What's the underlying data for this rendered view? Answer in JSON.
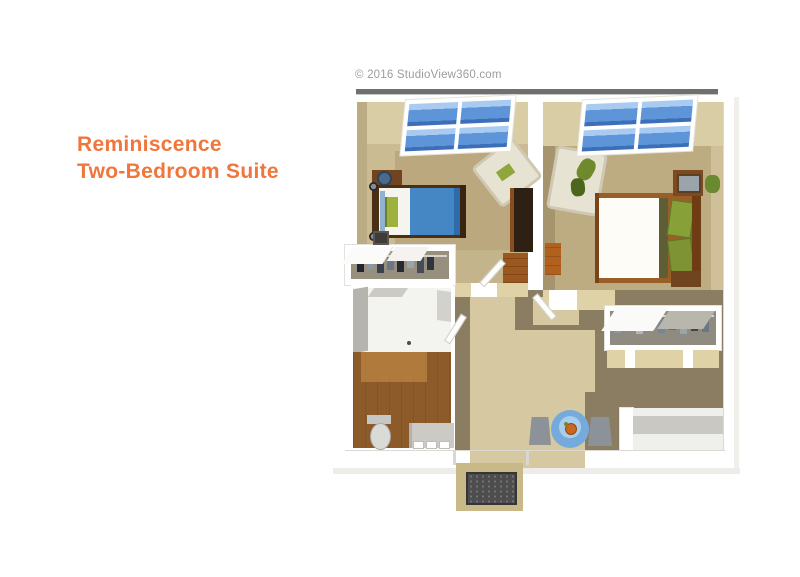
{
  "title": {
    "line1": "Reminiscence",
    "line2": "Two-Bedroom Suite",
    "color": "#F0763B"
  },
  "watermark": {
    "text": "© 2016 StudioView360.com",
    "color": "#9C9C9C"
  },
  "floorplan": {
    "type": "3d-birdseye-floor-plan",
    "unit_name": "Reminiscence Two-Bedroom Suite",
    "rooms": [
      {
        "name": "bedroom-1",
        "furniture": [
          "twin-bed-blue-blanket",
          "green-pillow",
          "nightstand-with-lamp",
          "bedside-stool",
          "cream-armchair",
          "dark-wardrobe",
          "dresser",
          "window-2x2-panes"
        ]
      },
      {
        "name": "bedroom-2",
        "furniture": [
          "bed-white-duvet",
          "green-pillows",
          "wood-bed-frame",
          "cream-armchair-with-plant",
          "media-dresser-tv",
          "small-plant",
          "orange-dresser",
          "nightstand",
          "window-2x2-panes"
        ]
      },
      {
        "name": "closet-1",
        "furniture": [
          "clothes-rod",
          "hanging-clothes",
          "sliding-door-panels"
        ]
      },
      {
        "name": "closet-2",
        "furniture": [
          "clothes-rod",
          "hanging-clothes",
          "sliding-door-panels"
        ]
      },
      {
        "name": "bathroom",
        "furniture": [
          "roll-in-shower",
          "shower-drain",
          "wood-floor",
          "toilet",
          "vanity-with-sink"
        ]
      },
      {
        "name": "living-dining",
        "furniture": [
          "round-blue-table",
          "orange-centerpiece",
          "dining-chair-left",
          "dining-chair-right"
        ]
      },
      {
        "name": "entry",
        "furniture": [
          "threshold",
          "doormat"
        ]
      }
    ],
    "colors": {
      "wall_white": "#FFFFFF",
      "wall_face_beige": "#D9CDA6",
      "bedroom_carpet": "#CBBB93",
      "bedroom_rug": "#BCA87E",
      "living_carpet": "#8A7D61",
      "hall_path": "#D6C8A0",
      "window_blue": "#5E95D8",
      "bed1_blanket_blue": "#4586C5",
      "bed2_duvet_white": "#FDFCF6",
      "pillow_green": "#87A038",
      "wood_frame": "#9A5E28",
      "wardrobe_dark": "#2E2013",
      "bath_wood_floor": "#8D5A29",
      "table_blue": "#74ABDC",
      "chair_gray": "#8D9298",
      "doormat_dark": "#4D4D4D",
      "doormat_surround": "#C9B888",
      "top_edge_gray": "#6F6F6F"
    }
  }
}
